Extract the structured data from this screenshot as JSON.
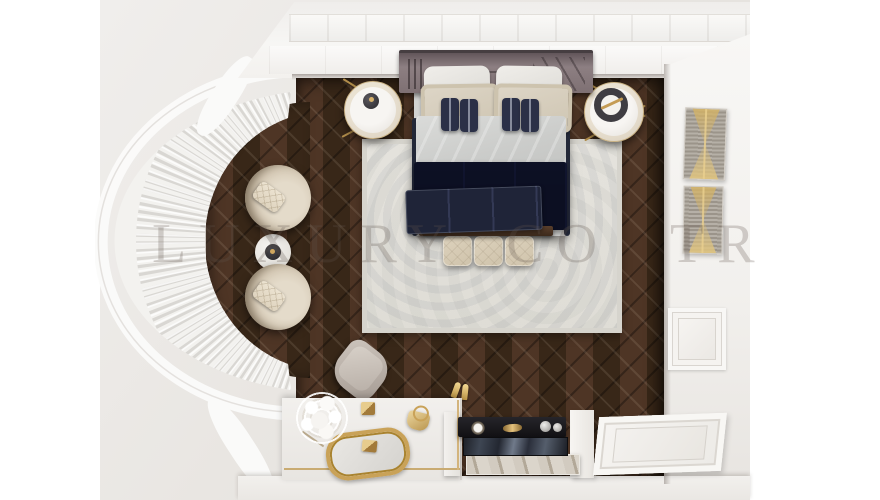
{
  "image": {
    "kind": "3d-interior-render-top-view",
    "subject": "Bird's-eye 3D render of a classic luxury bedroom furniture set",
    "canvas_width": 880,
    "canvas_height": 500
  },
  "watermark": {
    "segment1": "LUXURY",
    "segment2": "CO",
    "segment3": "TR",
    "color_hex": "#5f564f",
    "opacity": 0.26
  },
  "palette": {
    "backdrop_gray": "#e9e6e2",
    "wall_white": "#f5f4f2",
    "parquet_dark_brown": "#402d21",
    "rug_light_gray": "#dfddd7",
    "bed_navy": "#272c42",
    "headboard_mauve": "#7e7073",
    "cream_upholstery": "#d6cab6",
    "gold_accent": "#c9a258",
    "tv_black": "#17161a",
    "marble_beige": "#c9c2b6"
  },
  "scene": {
    "objects": [
      "upholstered mauve headboard",
      "double bed with white pillows, cream pillows, four navy accent pillows, light duvet, navy blanket and navy foot runner",
      "dark wood foot bench",
      "three quilted cream foot ottomans",
      "left round nightstand with dark vase",
      "right round nightstand with dark ring tray",
      "light patterned area rug",
      "dark herringbone parquet floor",
      "curved bay window with pleated sheer curtains",
      "two round cream armchairs with quilted lumbar pillows",
      "round side table with dark tray",
      "gray vanity stool",
      "white vanity dresser with gold oval mirror",
      "white flower bouquet",
      "two gold pyramid decor boxes",
      "gold handbag",
      "gold high-heel shoes",
      "sunglasses",
      "black TV console with clock and gold decor",
      "reflective TV screen",
      "marble bench shelf",
      "white carved door panel bottom-right",
      "two gold-striped abstract wall artworks",
      "white paneled top and right walls",
      "semi-transparent watermark text"
    ]
  }
}
